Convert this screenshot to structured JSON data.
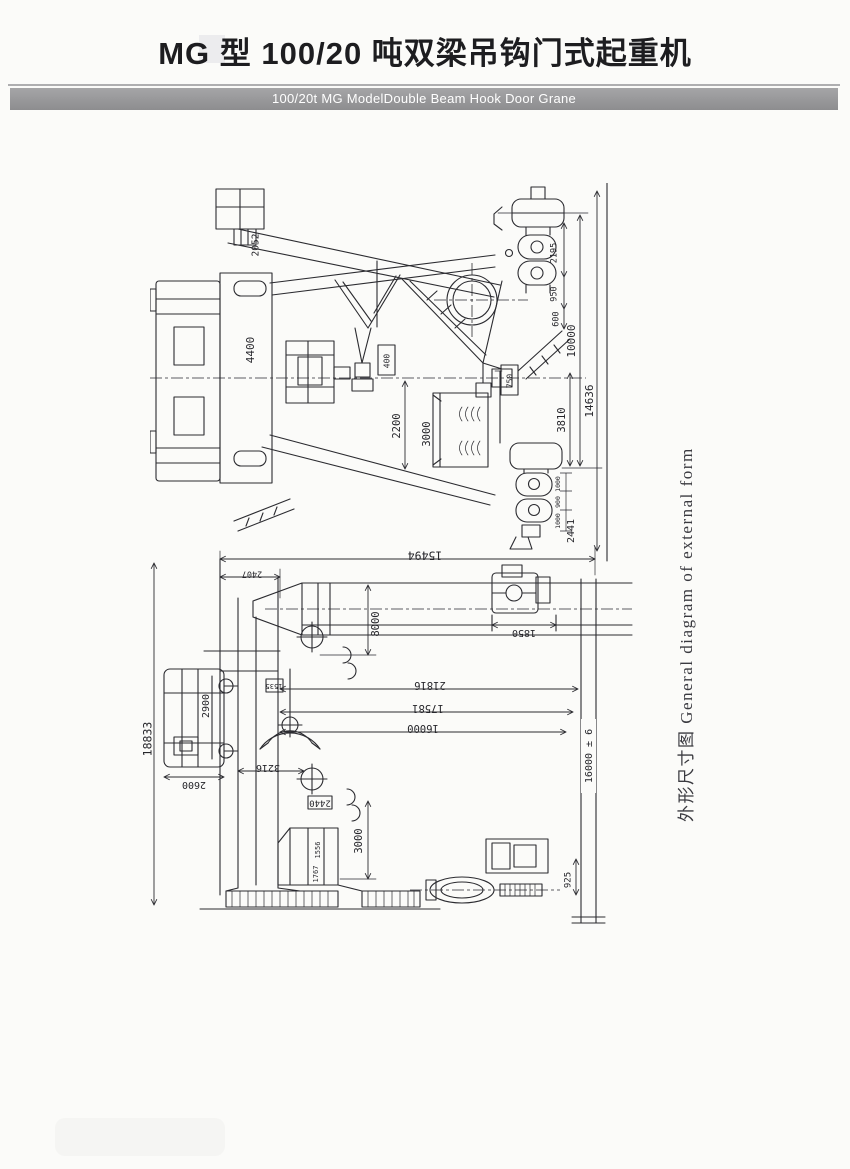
{
  "page": {
    "paper": "#fbfbf9",
    "ink": "#2b2b30"
  },
  "header": {
    "title": "MG 型 100/20 吨双梁吊钩门式起重机",
    "subtitle": "100/20t MG ModelDouble Beam Hook Door Grane",
    "bar_color": "#9a9a9c",
    "bar_text_color": "#ffffff"
  },
  "caption": {
    "text": "外形尺寸图  General diagram of external form"
  },
  "drawing_upper": {
    "dims": {
      "d2052": "2052",
      "d4400": "4400",
      "d400": "400",
      "d750": "750",
      "d2200": "2200",
      "d3000": "3000",
      "d3810": "3810",
      "d2195": "2195",
      "d950": "950",
      "d600": "600",
      "d10000": "10000",
      "d14636": "14636",
      "w1000a": "1000",
      "w900": "900",
      "w1000b": "1000",
      "d2441": "2441"
    }
  },
  "drawing_lower": {
    "dims": {
      "d15494": "15494",
      "d2407": "2407",
      "d18833": "18833",
      "d2900": "2900",
      "d2600": "2600",
      "d1535": "1535",
      "d3216": "3216",
      "d2440": "2440",
      "d3000": "3000",
      "d1556": "1556",
      "d1767": "1767",
      "d8000": "8000",
      "d21816": "21816",
      "d17581": "17581",
      "d16000": "16000",
      "d1850": "1850",
      "d16000tol": "16000 ± 6",
      "d925": "925"
    }
  }
}
